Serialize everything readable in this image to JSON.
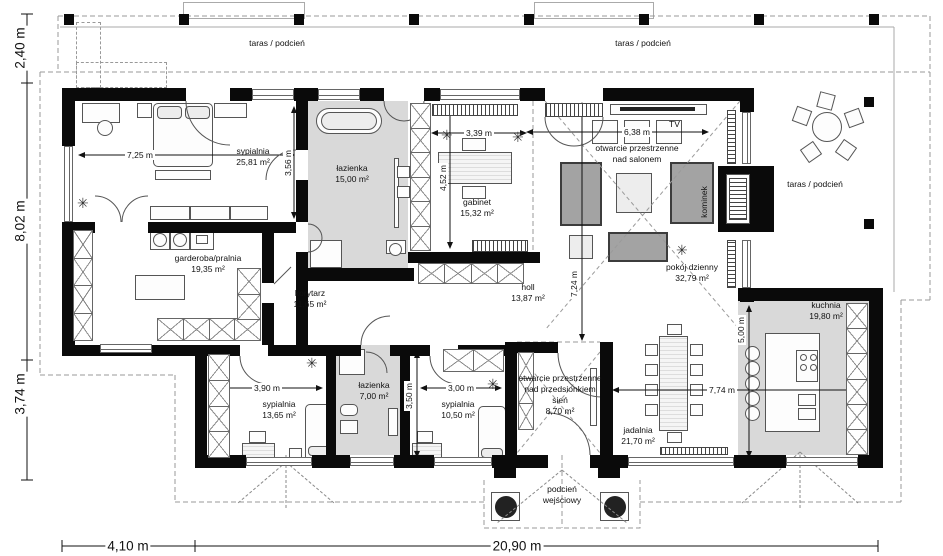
{
  "terraces": {
    "top1": "taras / podcień",
    "top2": "taras / podcień",
    "right": "taras / podcień"
  },
  "rooms": {
    "sypialnia1": {
      "name": "sypialnia",
      "area": "25,81 m²"
    },
    "lazienka1": {
      "name": "łazienka",
      "area": "15,00 m²"
    },
    "gabinet": {
      "name": "gabinet",
      "area": "15,32 m²"
    },
    "salon": {
      "name": "pokój dzienny",
      "area": "32,79 m²"
    },
    "garderoba": {
      "name": "garderoba/pralnia",
      "area": "19,35 m²"
    },
    "korytarz": {
      "name": "korytarz",
      "area": "11,65 m²"
    },
    "holl": {
      "name": "holl",
      "area": "13,87 m²"
    },
    "sypialnia2": {
      "name": "sypialnia",
      "area": "13,65 m²"
    },
    "lazienka2": {
      "name": "łazienka",
      "area": "7,00 m²"
    },
    "sypialnia3": {
      "name": "sypialnia",
      "area": "10,50 m²"
    },
    "jadalnia": {
      "name": "jadalnia",
      "area": "21,70 m²"
    },
    "kuchnia": {
      "name": "kuchnia",
      "area": "19,80 m²"
    },
    "sien": {
      "line1": "otwarcie przestrzenne",
      "line2": "nad przedsionkiem",
      "line3": "sień",
      "area": "8,70 m²"
    },
    "porch": {
      "line1": "podcień",
      "line2": "wejściowy"
    }
  },
  "annotations": {
    "salon_open1": "otwarcie przestrzenne",
    "salon_open2": "nad salonem",
    "tv": "TV",
    "kominek": "kominek"
  },
  "dimensions": {
    "left": [
      "2,40 m",
      "8,02 m",
      "3,74 m"
    ],
    "bottom": [
      "4,10 m",
      "20,90 m"
    ],
    "d725": "7,25 m",
    "d356": "3,56 m",
    "d339": "3,39 m",
    "d452": "4,52 m",
    "d638": "6,38 m",
    "d724": "7,24 m",
    "d390": "3,90 m",
    "d300": "3,00 m",
    "d350": "3,50 m",
    "d774": "7,74 m",
    "d500": "5,00 m"
  },
  "colors": {
    "wall": "#0a0a0a",
    "gray_room": "#d9d9d9",
    "sofa": "#a3a3a3",
    "dashed": "#999999"
  }
}
